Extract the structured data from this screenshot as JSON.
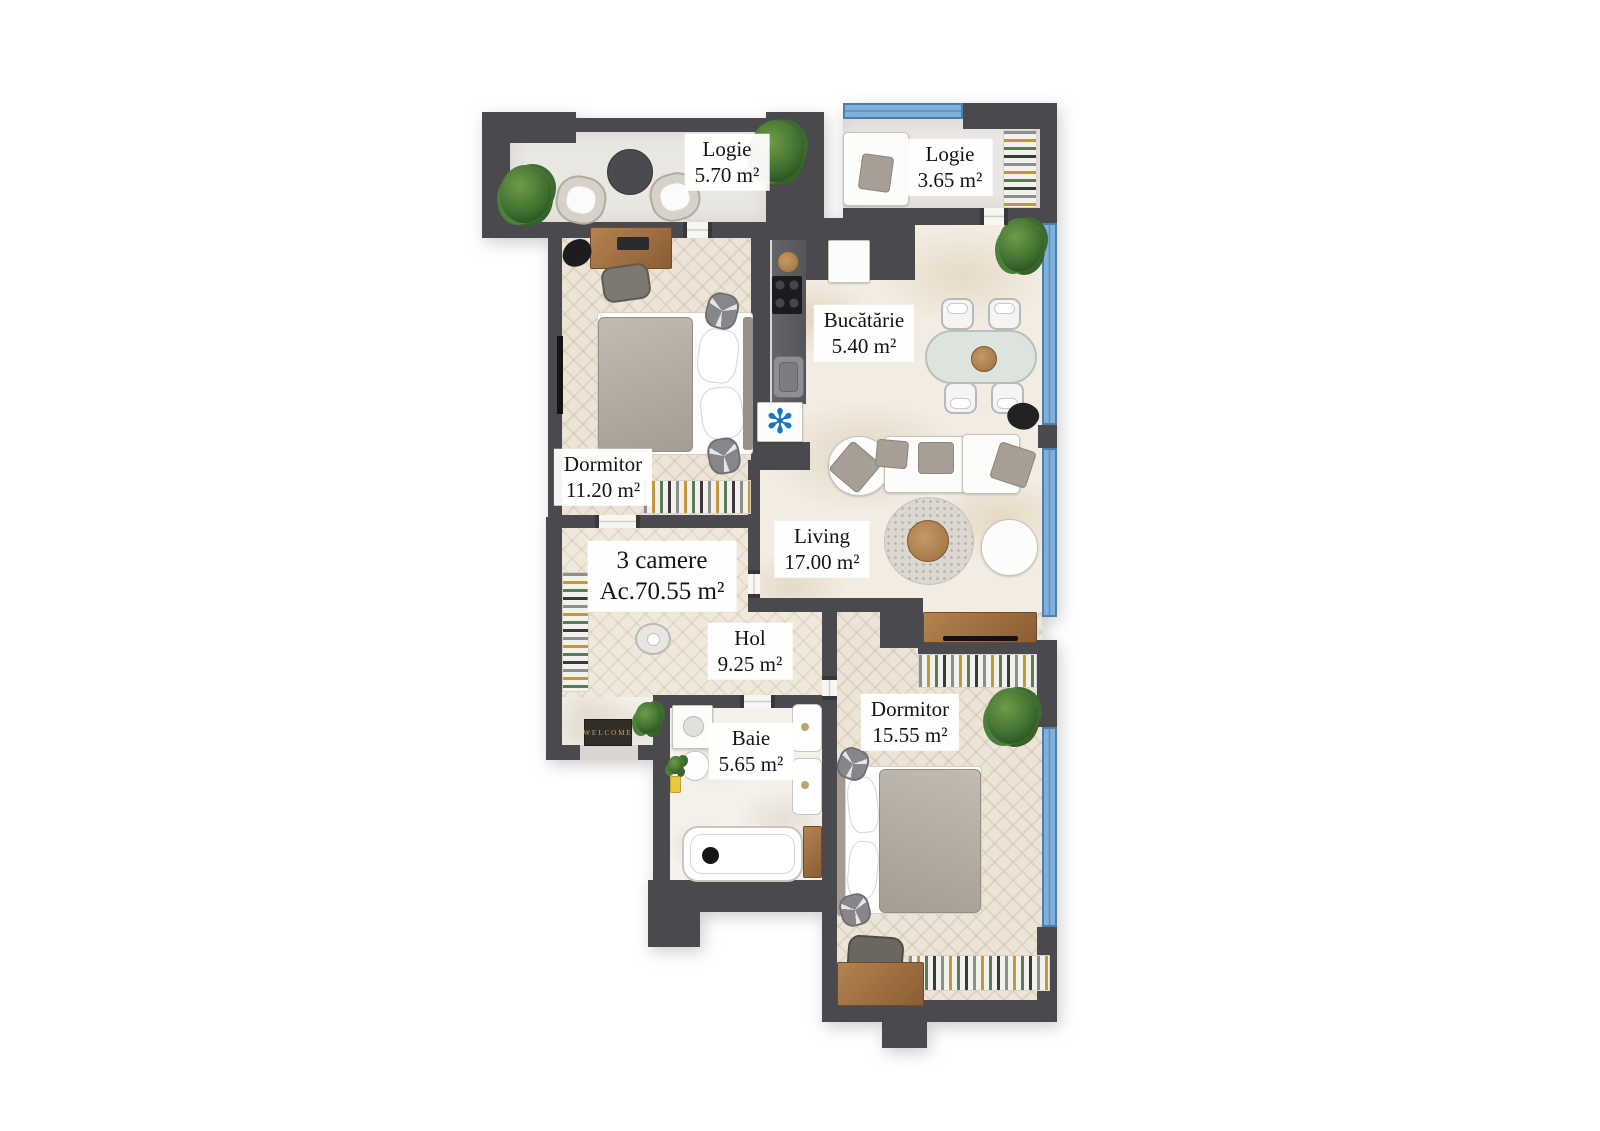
{
  "title": {
    "line1": "3 camere",
    "line2": "Ac.70.55 m²"
  },
  "rooms": [
    {
      "name": "Logie",
      "area": "5.70 m²"
    },
    {
      "name": "Logie",
      "area": "3.65 m²"
    },
    {
      "name": "Bucătărie",
      "area": "5.40 m²"
    },
    {
      "name": "Dormitor",
      "area": "11.20 m²"
    },
    {
      "name": "Living",
      "area": "17.00 m²"
    },
    {
      "name": "Hol",
      "area": "9.25 m²"
    },
    {
      "name": "Baie",
      "area": "5.65 m²"
    },
    {
      "name": "Dormitor",
      "area": "15.55 m²"
    }
  ],
  "entry_mat": {
    "text": "WELCOME"
  },
  "symbols": {
    "fridge": "✻"
  },
  "colors": {
    "wall": "#4a4a4e",
    "window_fill": "#7fb0dc",
    "window_edge": "#4c7fae",
    "fridge_symbol_blue": "#1878c8",
    "mat_text_gold": "#caa266",
    "floor_cream": "#ece4d6",
    "floor_marble": "#f2ece2"
  }
}
